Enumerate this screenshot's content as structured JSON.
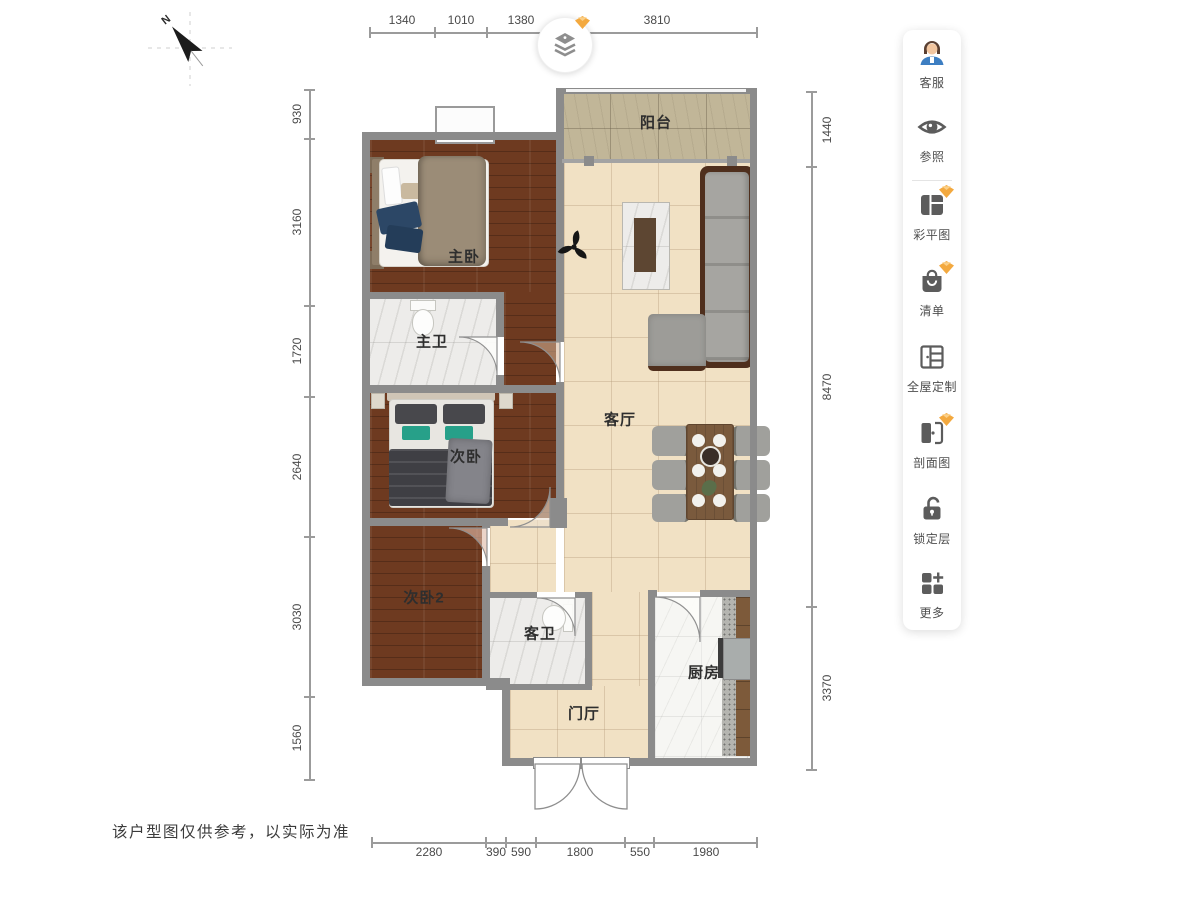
{
  "page": {
    "disclaimer": "该户型图仅供参考，以实际为准"
  },
  "compass": {
    "label": "N"
  },
  "plan": {
    "rooms": [
      {
        "name": "balcony",
        "label": "阳台"
      },
      {
        "name": "master-bedroom",
        "label": "主卧"
      },
      {
        "name": "master-bathroom",
        "label": "主卫"
      },
      {
        "name": "living-room",
        "label": "客厅"
      },
      {
        "name": "bedroom-2",
        "label": "次卧"
      },
      {
        "name": "bedroom-2b",
        "label": "次卧2"
      },
      {
        "name": "guest-bathroom",
        "label": "客卫"
      },
      {
        "name": "kitchen",
        "label": "厨房"
      },
      {
        "name": "entry-hall",
        "label": "门厅"
      }
    ],
    "dimensions": {
      "top": [
        "1340",
        "1010",
        "1380",
        "3810"
      ],
      "left": [
        "930",
        "3160",
        "1720",
        "2640",
        "3030",
        "1560"
      ],
      "right": [
        "1440",
        "8470",
        "3370"
      ],
      "bottom": [
        "2280",
        "390",
        "590",
        "1800",
        "550",
        "1980"
      ]
    }
  },
  "sidebar": {
    "items": [
      {
        "label": "客服",
        "icon": "support-agent-icon",
        "premium": false
      },
      {
        "label": "参照",
        "icon": "eye-icon",
        "premium": false
      },
      {
        "label": "彩平图",
        "icon": "color-plan-icon",
        "premium": true
      },
      {
        "label": "清单",
        "icon": "list-bag-icon",
        "premium": true
      },
      {
        "label": "全屋定制",
        "icon": "wardrobe-icon",
        "premium": false
      },
      {
        "label": "剖面图",
        "icon": "section-icon",
        "premium": true
      },
      {
        "label": "锁定层",
        "icon": "unlock-icon",
        "premium": false
      },
      {
        "label": "更多",
        "icon": "more-grid-icon",
        "premium": false
      }
    ]
  },
  "colors": {
    "gem_accent": "#f3a93f",
    "wall": "#8b8b8b",
    "wood_floor": "#6e3a20",
    "tile_beige": "#f1e1c4",
    "balcony_tile": "#c1b698"
  }
}
